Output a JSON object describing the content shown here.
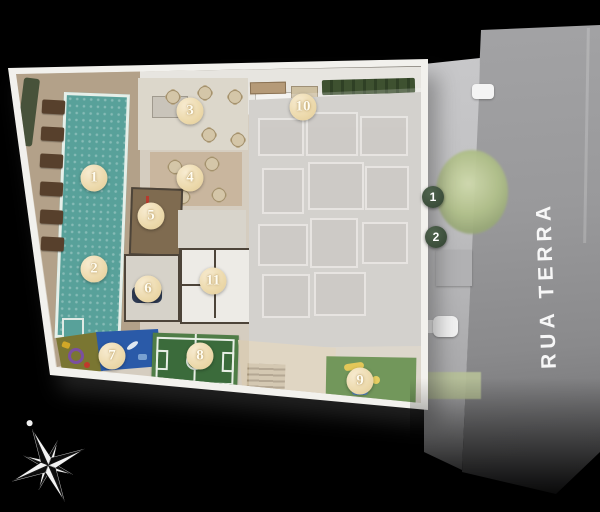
{
  "street": {
    "label": "RUA TERRA"
  },
  "markers": {
    "amenity": [
      {
        "label": "1",
        "x": 94,
        "y": 178
      },
      {
        "label": "2",
        "x": 94,
        "y": 269
      },
      {
        "label": "3",
        "x": 190,
        "y": 111
      },
      {
        "label": "4",
        "x": 190,
        "y": 178
      },
      {
        "label": "5",
        "x": 151,
        "y": 216
      },
      {
        "label": "6",
        "x": 148,
        "y": 289
      },
      {
        "label": "7",
        "x": 112,
        "y": 356
      },
      {
        "label": "8",
        "x": 200,
        "y": 356
      },
      {
        "label": "9",
        "x": 360,
        "y": 381
      },
      {
        "label": "10",
        "x": 303,
        "y": 107
      },
      {
        "label": "11",
        "x": 213,
        "y": 281
      }
    ],
    "street_points": [
      {
        "label": "1",
        "x": 433,
        "y": 197
      },
      {
        "label": "2",
        "x": 436,
        "y": 237
      }
    ]
  },
  "colors": {
    "background": "#000000",
    "card": "#f2f1ed",
    "plan_base": "#d5cdc0",
    "deck": "#b3a189",
    "pool": "#58a19a",
    "street": "#99999b",
    "sidewalk": "#c4c4c6",
    "footprint": "#c9c6c1",
    "court": "#3b6b3b",
    "court_frame": "#4f7d47",
    "playground_blue": "#2a5aa8",
    "playground_olive": "#7a7632",
    "lawn": "#4f7d33",
    "hedge": "#3e5130",
    "marker_cream": "#ecd9ab",
    "marker_green": "#3b4d3a",
    "marker_text_cream": "#fffdf2",
    "marker_text_green": "#ffffff",
    "street_text": "#f7f7f7"
  }
}
